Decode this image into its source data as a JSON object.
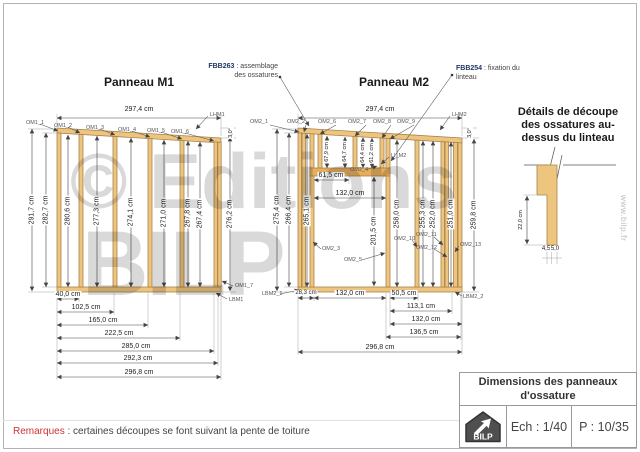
{
  "sheet": {
    "remark_label": "Remarques",
    "remark_text": " : certaines découpes se font suivant la pente de toiture"
  },
  "watermark": {
    "line1": "© Editions",
    "line2": "BILP",
    "site": "www.bilp.fr"
  },
  "callout_fbb263": {
    "code": "FBB263",
    "text1": " : assemblage",
    "text2": "des ossatures"
  },
  "callout_fbb254": {
    "code": "FBB254",
    "text1": " : fixation du",
    "text2": "linteau"
  },
  "m1": {
    "title": "Panneau M1",
    "dim_top": "297,4 cm",
    "angle": "3,0°",
    "vdims": [
      "291,7 cm",
      "282,7 cm",
      "280,6 cm",
      "277,3 cm",
      "274,1 cm",
      "271,0 cm",
      "267,8 cm",
      "267,4 cm",
      "276,2 cm"
    ],
    "hdims": [
      "40,0 cm",
      "102,5 cm",
      "165,0 cm",
      "222,5 cm",
      "285,0 cm",
      "292,3 cm",
      "296,8 cm"
    ],
    "studs_top": [
      "OM1_1",
      "OM1_2",
      "OM1_3",
      "OM1_4",
      "OM1_5",
      "OM1_6"
    ],
    "lhm": "LHM1",
    "om7": "OM1_7",
    "lbm": "LBM1"
  },
  "m2": {
    "title": "Panneau M2",
    "dim_top": "297,4 cm",
    "angle": "3,0°",
    "vdims_left": [
      "275,4 cm",
      "266,4 cm",
      "265,1 cm"
    ],
    "dim_door_h": "201,5 cm",
    "dims_lintel": [
      "67,9 cm",
      "64,7 cm",
      "64,4 cm",
      "61,2 cm"
    ],
    "dim_above_door_w": "61,5 cm",
    "dim_door_w": "132,0 cm",
    "vdims_right": [
      "258,0 cm",
      "255,3 cm",
      "252,0 cm",
      "251,0 cm",
      "259,8 cm"
    ],
    "hdims_row1": [
      "28,3 cm",
      "132,0 cm",
      "50,5 cm"
    ],
    "hdims_rows": [
      "113,1 cm",
      "132,0 cm",
      "136,5 cm",
      "296,8 cm"
    ],
    "studs_top": [
      "OM2_1",
      "OM2_2",
      "OM2_6",
      "OM2_7",
      "OM2_8",
      "OM2_9"
    ],
    "lhm": "LHM2",
    "lintel": "LI_M2",
    "om3": "OM2_3",
    "om4": "OM2_4",
    "om5": "OM2_5",
    "om10": "OM2_10",
    "om11": "OM2_11",
    "om12": "OM2_12",
    "om13": "OM2_13",
    "lbm1": "LBM2_1",
    "lbm2": "LBM2_2"
  },
  "detail": {
    "title1": "Détails de découpe",
    "title2": "des ossatures au-",
    "title3": "dessus du linteau",
    "dim_v": "22,0 cm",
    "dim_b1": "4,5",
    "dim_b2": "5,0"
  },
  "titleblock": {
    "title1": "Dimensions des panneaux",
    "title2": "d'ossature",
    "scale": "Ech : 1/40",
    "page": "P : 10/35",
    "logo_text": "BILP"
  },
  "colors": {
    "wood": "#eec57f",
    "callout": "#1f3864",
    "remark_red": "#cc3333"
  }
}
